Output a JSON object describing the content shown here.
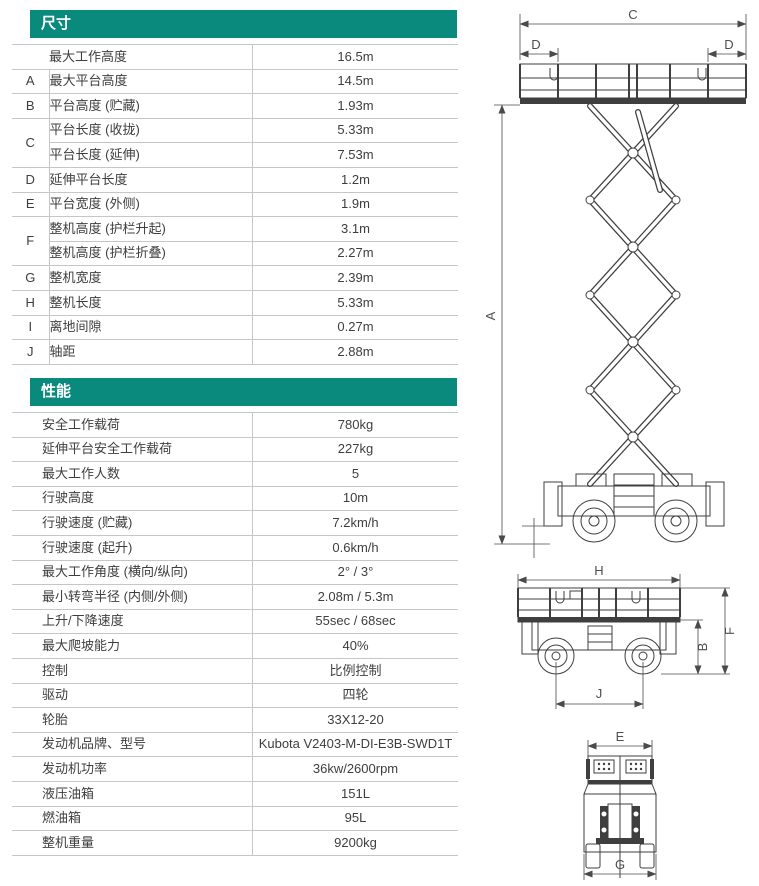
{
  "page": {
    "background_color": "#ffffff",
    "accent_color": "#0a897d",
    "line_color": "#c6c6c6",
    "text_color": "#3e3e3e"
  },
  "dimensions": {
    "title": "尺寸",
    "rows": [
      {
        "letter": "",
        "label": "最大工作高度",
        "value": "16.5m"
      },
      {
        "letter": "A",
        "label": "最大平台高度",
        "value": "14.5m"
      },
      {
        "letter": "B",
        "label": "平台高度 (贮藏)",
        "value": "1.93m"
      },
      {
        "letter": "C",
        "label": "平台长度 (收拢)",
        "value": "5.33m"
      },
      {
        "letter": "",
        "label": "平台长度 (延伸)",
        "value": "7.53m"
      },
      {
        "letter": "D",
        "label": "延伸平台长度",
        "value": "1.2m"
      },
      {
        "letter": "E",
        "label": "平台宽度 (外侧)",
        "value": "1.9m"
      },
      {
        "letter": "F",
        "label": "整机高度 (护栏升起)",
        "value": "3.1m"
      },
      {
        "letter": "",
        "label": "整机高度 (护栏折叠)",
        "value": "2.27m"
      },
      {
        "letter": "G",
        "label": "整机宽度",
        "value": "2.39m"
      },
      {
        "letter": "H",
        "label": "整机长度",
        "value": "5.33m"
      },
      {
        "letter": "I",
        "label": "离地间隙",
        "value": "0.27m"
      },
      {
        "letter": "J",
        "label": "轴距",
        "value": "2.88m"
      }
    ]
  },
  "performance": {
    "title": "性能",
    "rows": [
      {
        "label": "安全工作载荷",
        "value": "780kg"
      },
      {
        "label": "延伸平台安全工作载荷",
        "value": "227kg"
      },
      {
        "label": "最大工作人数",
        "value": "5"
      },
      {
        "label": "行驶高度",
        "value": "10m"
      },
      {
        "label": "行驶速度 (贮藏)",
        "value": "7.2km/h"
      },
      {
        "label": "行驶速度 (起升)",
        "value": "0.6km/h"
      },
      {
        "label": "最大工作角度 (横向/纵向)",
        "value": "2° / 3°"
      },
      {
        "label": "最小转弯半径 (内侧/外侧)",
        "value": "2.08m / 5.3m"
      },
      {
        "label": "上升/下降速度",
        "value": "55sec / 68sec"
      },
      {
        "label": "最大爬坡能力",
        "value": "40%"
      },
      {
        "label": "控制",
        "value": "比例控制"
      },
      {
        "label": "驱动",
        "value": "四轮"
      },
      {
        "label": "轮胎",
        "value": "33X12-20"
      },
      {
        "label": "发动机品牌、型号",
        "value": "Kubota V2403-M-DI-E3B-SWD1T"
      },
      {
        "label": "发动机功率",
        "value": "36kw/2600rpm"
      },
      {
        "label": "液压油箱",
        "value": "151L"
      },
      {
        "label": "燃油箱",
        "value": "95L"
      },
      {
        "label": "整机重量",
        "value": "9200kg"
      }
    ]
  },
  "drawings": {
    "extended_view": {
      "dim_platform_length": "C",
      "dim_deck_left": "D",
      "dim_deck_right": "D",
      "dim_platform_height": "A"
    },
    "stowed_view": {
      "dim_machine_length": "H",
      "dim_overall_height": "F",
      "dim_stowed_height": "B",
      "dim_wheelbase": "J"
    },
    "rear_view": {
      "dim_platform_width": "E",
      "dim_overall_width": "G"
    }
  }
}
